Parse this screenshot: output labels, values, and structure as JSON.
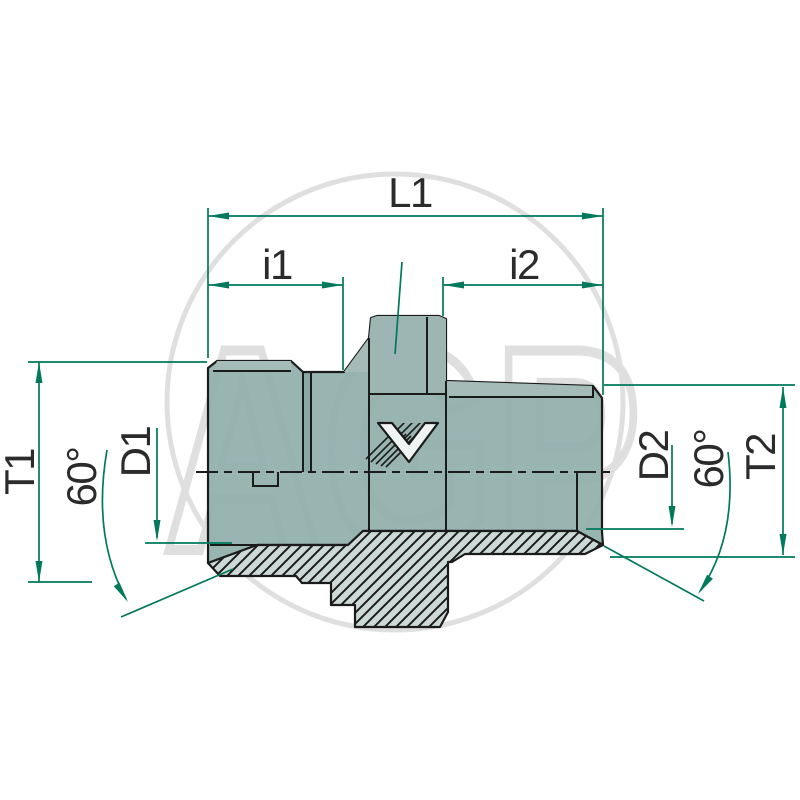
{
  "drawing": {
    "title": "threaded-adapter-fitting-dimension-drawing",
    "watermark_text": "AGP",
    "logo_text": "V",
    "labels": {
      "l1": "L1",
      "i1": "i1",
      "i2": "i2",
      "t1": "T1",
      "d1": "D1",
      "angle_left": "60°",
      "d2": "D2",
      "angle_right": "60°",
      "t2": "T2"
    }
  },
  "colors": {
    "green": "#00795c",
    "ink": "#1b1b1b",
    "teal": "#93b0ad",
    "tealLight": "#a4bbb8",
    "tealLighter": "#9db6b3",
    "hatchFill": "#cdd9d6",
    "watermark": "#dfdfdf",
    "label": "#2b2b2b",
    "bg": "#ffffff"
  }
}
